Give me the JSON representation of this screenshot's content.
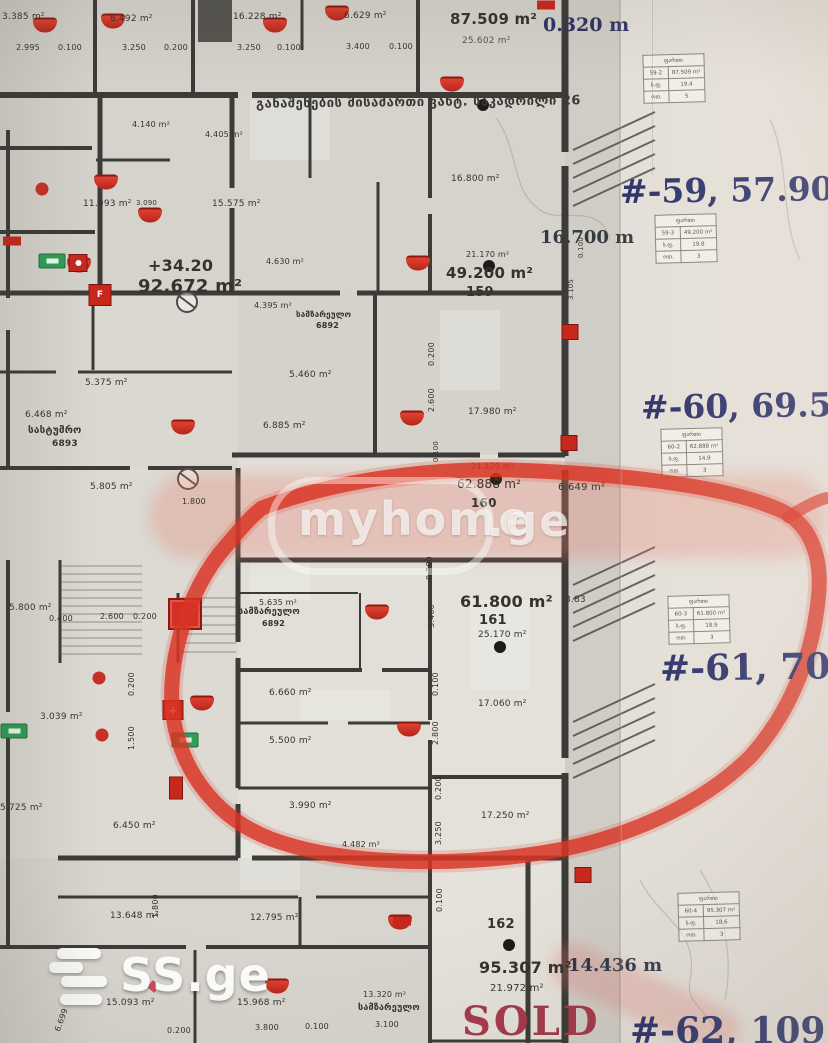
{
  "colors": {
    "marker_red": "#d93424",
    "annotation_navy": "#2a3168",
    "sold_red": "#a53a4b",
    "exit_green": "#2f9e56",
    "ink": "#34332e"
  },
  "watermark": {
    "brand": "myhome",
    "tld": ".ge"
  },
  "logo": {
    "brand": "SS.ge"
  },
  "corridor_title": "განაშენების მისამართი ვახტ. საკადრილი 26",
  "annotations": {
    "n59": "#-59, 57.90kv.m",
    "n60": "#-60, 69.50kv",
    "n61": "#-61, 70.60k",
    "n62": "#-62, 109.7",
    "sold": "SOLD",
    "dim_top": "0.320 m",
    "dim_mid": "16.700 m",
    "dim_bottom": "14.436 m"
  },
  "units": [
    {
      "id": "159",
      "area_total": "49.200 m²",
      "area_sub": "21.170 m²"
    },
    {
      "id": "160",
      "area_total": "62.888 m²",
      "area_sub": "24.420 m²"
    },
    {
      "id": "161",
      "area_total": "61.800 m²",
      "area_sub": "25.170 m²",
      "marked": "red circle"
    },
    {
      "id": "162",
      "area_total": "95.307 m²",
      "area_sub": "21.972 m²",
      "status": "SOLD"
    },
    {
      "id": "",
      "area_total": "87.509 m²",
      "area_sub": "25.602 m²"
    },
    {
      "id": "",
      "area_total": "92.672 m²",
      "level": "+34.20"
    }
  ],
  "plan": {
    "labels": [
      {
        "t": "3.385 m²",
        "x": 2,
        "y": 13
      },
      {
        "t": "2.995",
        "x": 16,
        "y": 44,
        "s": 8
      },
      {
        "t": "0.100",
        "x": 58,
        "y": 44,
        "s": 8
      },
      {
        "t": "8.492 m²",
        "x": 110,
        "y": 15
      },
      {
        "t": "3.250",
        "x": 122,
        "y": 44,
        "s": 8
      },
      {
        "t": "0.200",
        "x": 164,
        "y": 44,
        "s": 8
      },
      {
        "t": "16.228 m²",
        "x": 233,
        "y": 13
      },
      {
        "t": "3.250",
        "x": 237,
        "y": 44,
        "s": 8
      },
      {
        "t": "0.100",
        "x": 277,
        "y": 44,
        "s": 8
      },
      {
        "t": "6.629 m²",
        "x": 344,
        "y": 12
      },
      {
        "t": "3.400",
        "x": 346,
        "y": 43,
        "s": 8
      },
      {
        "t": "0.100",
        "x": 389,
        "y": 43,
        "s": 8
      },
      {
        "t": "87.509 m²",
        "x": 450,
        "y": 12,
        "s": 15,
        "w": 600
      },
      {
        "t": "25.602 m²",
        "x": 462,
        "y": 37,
        "c": "soft"
      },
      {
        "t": "4.140 m²",
        "x": 132,
        "y": 121,
        "s": 8
      },
      {
        "t": "4.405 m²",
        "x": 205,
        "y": 131,
        "s": 8
      },
      {
        "t": "16.800 m²",
        "x": 451,
        "y": 175
      },
      {
        "t": "15.575 m²",
        "x": 212,
        "y": 200
      },
      {
        "t": "11.093 m²",
        "x": 83,
        "y": 200
      },
      {
        "t": "3.090",
        "x": 136,
        "y": 200,
        "s": 7
      },
      {
        "t": "+34.20",
        "x": 148,
        "y": 258,
        "s": 16,
        "w": 700
      },
      {
        "t": "92.672 m²",
        "x": 138,
        "y": 278,
        "s": 18,
        "w": 700
      },
      {
        "t": "21.170 m²",
        "x": 466,
        "y": 251,
        "s": 8
      },
      {
        "t": "49.200 m²",
        "x": 446,
        "y": 266,
        "s": 15,
        "w": 600
      },
      {
        "t": "159",
        "x": 466,
        "y": 286,
        "s": 13,
        "w": 600
      },
      {
        "t": "4.630 m²",
        "x": 266,
        "y": 258,
        "s": 8
      },
      {
        "t": "4.395 m²",
        "x": 254,
        "y": 302,
        "s": 8
      },
      {
        "t": "სამზარეულო",
        "x": 296,
        "y": 311,
        "s": 8,
        "w": 700
      },
      {
        "t": "6892",
        "x": 316,
        "y": 322,
        "s": 8,
        "w": 700
      },
      {
        "t": "5.460 m²",
        "x": 289,
        "y": 371
      },
      {
        "t": "6.885 m²",
        "x": 263,
        "y": 422
      },
      {
        "t": "17.980 m²",
        "x": 468,
        "y": 408
      },
      {
        "t": "5.375 m²",
        "x": 85,
        "y": 379
      },
      {
        "t": "6.468 m²",
        "x": 25,
        "y": 411
      },
      {
        "t": "სასტუმრო",
        "x": 28,
        "y": 426,
        "s": 10,
        "w": 700
      },
      {
        "t": "6893",
        "x": 52,
        "y": 440,
        "s": 9,
        "w": 700
      },
      {
        "t": "5.805 m²",
        "x": 90,
        "y": 483
      },
      {
        "t": "1.800",
        "x": 182,
        "y": 498,
        "s": 8
      },
      {
        "t": "24.420 m²",
        "x": 471,
        "y": 463,
        "s": 8
      },
      {
        "t": "62.888 m²",
        "x": 457,
        "y": 478,
        "s": 12
      },
      {
        "t": "160",
        "x": 471,
        "y": 497,
        "s": 12,
        "w": 600
      },
      {
        "t": "6.649 m²",
        "x": 558,
        "y": 483,
        "s": 10
      },
      {
        "t": "5.635 m²",
        "x": 259,
        "y": 599,
        "s": 8
      },
      {
        "t": "სამზარეულო",
        "x": 238,
        "y": 608,
        "s": 9,
        "w": 700
      },
      {
        "t": "6892",
        "x": 262,
        "y": 620,
        "s": 8,
        "w": 700
      },
      {
        "t": "61.800 m²",
        "x": 460,
        "y": 594,
        "s": 16,
        "w": 600
      },
      {
        "t": "161",
        "x": 479,
        "y": 614,
        "s": 13,
        "w": 600
      },
      {
        "t": "25.170 m²",
        "x": 478,
        "y": 631
      },
      {
        "t": "6.660 m²",
        "x": 269,
        "y": 689
      },
      {
        "t": "5.500 m²",
        "x": 269,
        "y": 737
      },
      {
        "t": "17.060 m²",
        "x": 478,
        "y": 700
      },
      {
        "t": "17.250 m²",
        "x": 481,
        "y": 812
      },
      {
        "t": "3.990 m²",
        "x": 289,
        "y": 802
      },
      {
        "t": "4.482 m²",
        "x": 342,
        "y": 841,
        "s": 8
      },
      {
        "t": "5.800 m²",
        "x": 9,
        "y": 604
      },
      {
        "t": "0.400",
        "x": 49,
        "y": 615,
        "s": 8
      },
      {
        "t": "2.600",
        "x": 100,
        "y": 613,
        "s": 8
      },
      {
        "t": "0.200",
        "x": 133,
        "y": 613,
        "s": 8
      },
      {
        "t": "3.039 m²",
        "x": 40,
        "y": 713
      },
      {
        "t": "5.725 m²",
        "x": 0,
        "y": 804
      },
      {
        "t": "6.450 m²",
        "x": 113,
        "y": 822
      },
      {
        "t": "13.648 m²",
        "x": 110,
        "y": 912
      },
      {
        "t": "12.795 m²",
        "x": 250,
        "y": 914
      },
      {
        "t": "15.093 m²",
        "x": 106,
        "y": 999
      },
      {
        "t": "15.968 m²",
        "x": 237,
        "y": 999
      },
      {
        "t": "13.320 m²",
        "x": 363,
        "y": 991,
        "s": 8
      },
      {
        "t": "სამზარეულო",
        "x": 358,
        "y": 1004,
        "s": 9,
        "w": 700
      },
      {
        "t": "0.200",
        "x": 167,
        "y": 1027,
        "s": 8
      },
      {
        "t": "3.800",
        "x": 255,
        "y": 1024,
        "s": 8
      },
      {
        "t": "0.100",
        "x": 305,
        "y": 1023,
        "s": 8
      },
      {
        "t": "3.100",
        "x": 375,
        "y": 1021,
        "s": 8
      },
      {
        "t": "6.699",
        "x": 54,
        "y": 1030,
        "s": 8,
        "r": -70
      },
      {
        "t": "95.307 m²",
        "x": 479,
        "y": 960,
        "s": 16,
        "w": 600
      },
      {
        "t": "21.972 m²",
        "x": 490,
        "y": 984,
        "s": 10
      },
      {
        "t": "162",
        "x": 487,
        "y": 918,
        "s": 13,
        "w": 600
      },
      {
        "t": "3.83",
        "x": 565,
        "y": 596
      },
      {
        "t": "0.200",
        "x": 426,
        "y": 580,
        "s": 8,
        "r": -90
      },
      {
        "t": "3.400",
        "x": 428,
        "y": 628,
        "s": 8,
        "r": -90
      },
      {
        "t": "0.100",
        "x": 432,
        "y": 696,
        "s": 8,
        "r": -90
      },
      {
        "t": "2.800",
        "x": 432,
        "y": 745,
        "s": 8,
        "r": -90
      },
      {
        "t": "0.200",
        "x": 435,
        "y": 800,
        "s": 8,
        "r": -90
      },
      {
        "t": "3.250",
        "x": 435,
        "y": 845,
        "s": 8,
        "r": -90
      },
      {
        "t": "0.100",
        "x": 436,
        "y": 912,
        "s": 8,
        "r": -90
      },
      {
        "t": "1.500",
        "x": 128,
        "y": 750,
        "s": 8,
        "r": -90
      },
      {
        "t": "0.200",
        "x": 128,
        "y": 696,
        "s": 8,
        "r": -90
      },
      {
        "t": "1.800",
        "x": 152,
        "y": 918,
        "s": 8,
        "r": -90
      },
      {
        "t": "0.200",
        "x": 428,
        "y": 366,
        "s": 8,
        "r": -90
      },
      {
        "t": "2.600",
        "x": 428,
        "y": 412,
        "s": 8,
        "r": -90
      },
      {
        "t": "3.105",
        "x": 568,
        "y": 300,
        "s": 7,
        "r": -90
      },
      {
        "t": "0.100",
        "x": 578,
        "y": 258,
        "s": 7,
        "r": -90
      },
      {
        "t": "0.100",
        "x": 433,
        "y": 462,
        "s": 7,
        "r": -90
      }
    ],
    "icons": [
      [
        "awning",
        45,
        25
      ],
      [
        "awning",
        113,
        21
      ],
      [
        "awning",
        275,
        25
      ],
      [
        "awning",
        337,
        13
      ],
      [
        "awning",
        452,
        84
      ],
      [
        "awning",
        106,
        182
      ],
      [
        "awning",
        150,
        215
      ],
      [
        "awning",
        79,
        265
      ],
      [
        "awning",
        418,
        263
      ],
      [
        "awning",
        412,
        418
      ],
      [
        "awning",
        183,
        427
      ],
      [
        "awning",
        377,
        612
      ],
      [
        "awning",
        409,
        729
      ],
      [
        "awning",
        202,
        703
      ],
      [
        "awning",
        277,
        986
      ],
      [
        "awning",
        400,
        922
      ],
      [
        "rrect",
        12,
        241
      ],
      [
        "rrect",
        546,
        5
      ],
      [
        "rrect",
        402,
        921
      ],
      [
        "dot",
        42,
        189
      ],
      [
        "dot",
        99,
        678
      ],
      [
        "dot",
        102,
        735
      ],
      [
        "bdot",
        489,
        266
      ],
      [
        "bdot",
        496,
        479
      ],
      [
        "bdot",
        500,
        647
      ],
      [
        "bdot",
        509,
        945
      ],
      [
        "bdot",
        483,
        105
      ],
      [
        "sq",
        570,
        332
      ],
      [
        "sq",
        569,
        443
      ],
      [
        "sq",
        583,
        875
      ],
      [
        "sqbig",
        185,
        614
      ],
      [
        "sqdot",
        78,
        263
      ],
      [
        "sqf",
        100,
        295
      ],
      [
        "sqx",
        173,
        710
      ],
      [
        "exit",
        14,
        731
      ],
      [
        "exit",
        185,
        740
      ],
      [
        "exit",
        52,
        261
      ],
      [
        "vrect",
        176,
        788
      ]
    ],
    "tables": [
      {
        "x": 643,
        "y": 54,
        "header": "ფართი",
        "rows": [
          [
            "59-2",
            "87.509 m²"
          ],
          [
            "ს.ფ.",
            "19.4"
          ],
          [
            "ოთ.",
            "5"
          ]
        ]
      },
      {
        "x": 655,
        "y": 214,
        "header": "ფართი",
        "rows": [
          [
            "59-3",
            "49.200 m²"
          ],
          [
            "ს.ფ.",
            "19.8"
          ],
          [
            "ოთ.",
            "3"
          ]
        ]
      },
      {
        "x": 661,
        "y": 428,
        "header": "ფართი",
        "rows": [
          [
            "60-2",
            "62.888 m²"
          ],
          [
            "ს.ფ.",
            "14.9"
          ],
          [
            "ოთ.",
            "3"
          ]
        ]
      },
      {
        "x": 668,
        "y": 595,
        "header": "ფართი",
        "rows": [
          [
            "60-3",
            "61.800 m²"
          ],
          [
            "ს.ფ.",
            "18.9"
          ],
          [
            "ოთ.",
            "3"
          ]
        ]
      },
      {
        "x": 678,
        "y": 892,
        "header": "ფართი",
        "rows": [
          [
            "60-4",
            "95.307 m²"
          ],
          [
            "ს.ფ.",
            "18.6"
          ],
          [
            "ოთ.",
            "3"
          ]
        ]
      }
    ]
  }
}
